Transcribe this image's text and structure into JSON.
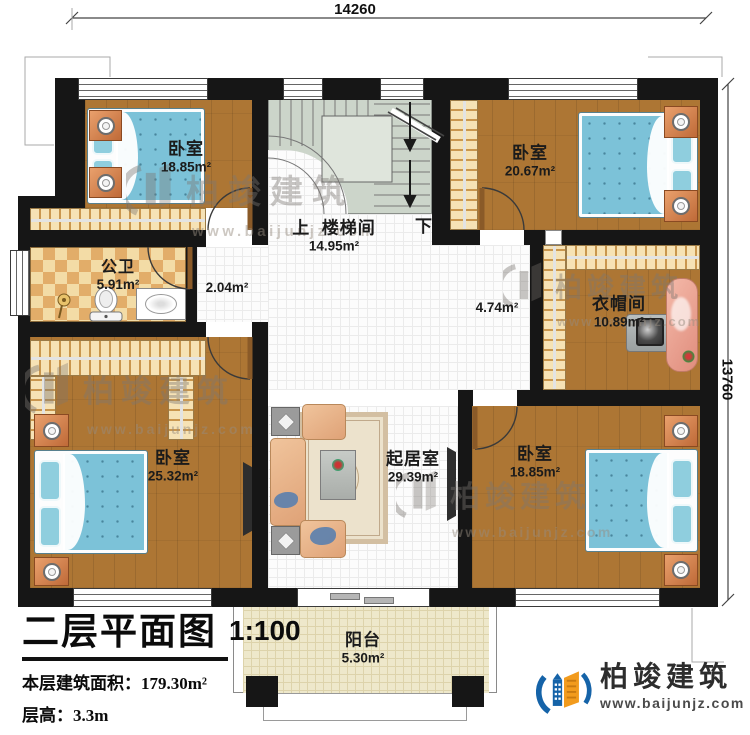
{
  "dimensions": {
    "top": "14260",
    "right": "13760"
  },
  "stairwell": {
    "up": "上",
    "down": "下",
    "name": "楼梯间",
    "area": "14.95m²"
  },
  "rooms": {
    "bedroom_tl": {
      "name": "卧室",
      "area": "18.85m²"
    },
    "bedroom_tr": {
      "name": "卧室",
      "area": "20.67m²"
    },
    "bathroom": {
      "name": "公卫",
      "area": "5.91m²"
    },
    "corridor": {
      "area": "2.04m²"
    },
    "hall": {
      "area": "4.74m²"
    },
    "cloakroom": {
      "name": "衣帽间",
      "area": "10.89m²"
    },
    "bedroom_bl": {
      "name": "卧室",
      "area": "25.32m²"
    },
    "living_room": {
      "name": "起居室",
      "area": "29.39m²"
    },
    "bedroom_br": {
      "name": "卧室",
      "area": "18.85m²"
    },
    "balcony": {
      "name": "阳台",
      "area": "5.30m²"
    }
  },
  "title_block": {
    "title": "二层平面图",
    "scale": "1:100",
    "floor_area_line": "本层建筑面积：179.30m²",
    "floor_height_line": "层高：3.3m"
  },
  "brand": {
    "name": "柏竣建筑",
    "url": "www.baijunjz.com"
  },
  "watermark": {
    "name": "柏竣建筑",
    "url": "www.baijunjz.com"
  },
  "colors": {
    "wall": "#161616",
    "wood": "#ad7634",
    "stair": "#ccd5ca",
    "balcony": "#eee8cb",
    "checker_a": "#f3dca6",
    "checker_b": "#e2ad69",
    "closet": "#f6e2b5",
    "bed_blue": "#7cc2d8",
    "accent_blue": "#1563a8",
    "accent_orange": "#f29b1d"
  }
}
